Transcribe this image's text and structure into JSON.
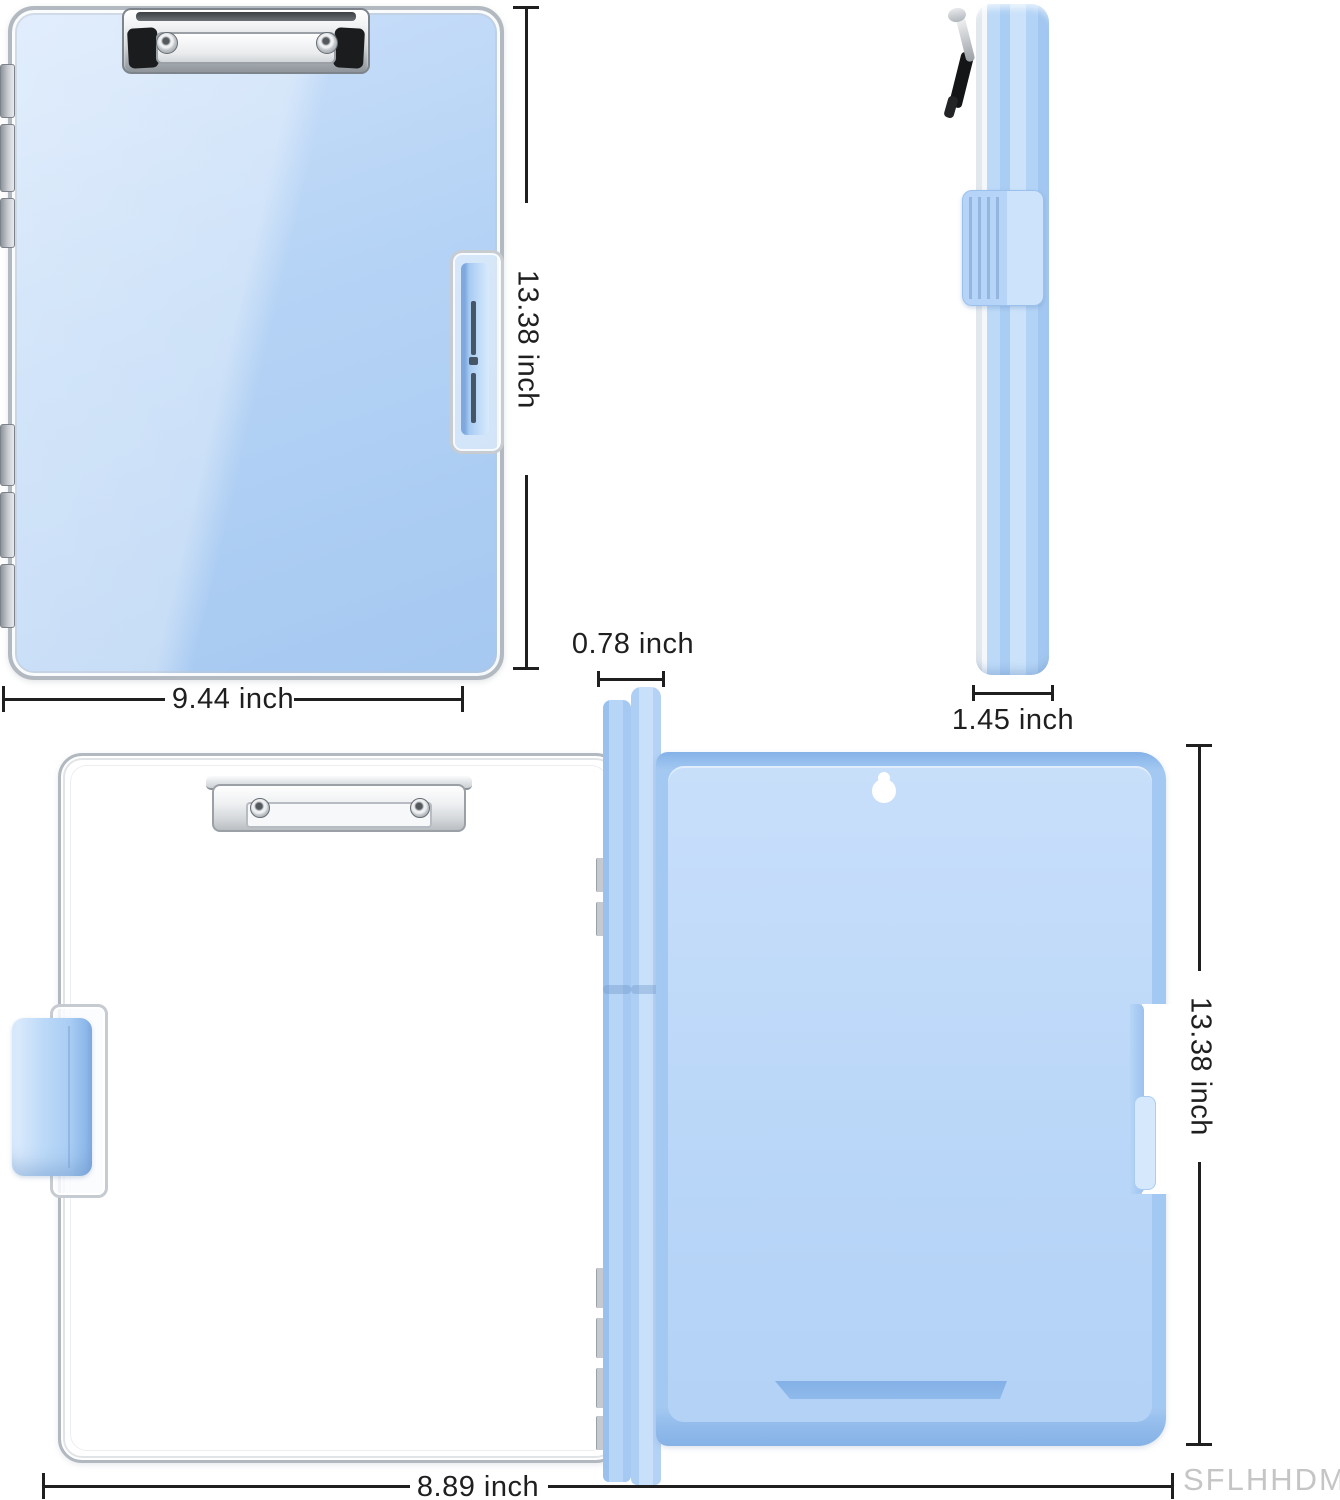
{
  "diagram": {
    "watermark": "SFLHHDM",
    "dimensions": {
      "front_height": "13.38 inch",
      "front_width": "9.44 inch",
      "spine_thickness": "0.78 inch",
      "side_thickness": "1.45 inch",
      "back_height": "13.38 inch",
      "back_width": "8.89 inch"
    },
    "icons": {
      "hang_hole": "keyhole-shape",
      "clip": "metal-spring-clip",
      "latch": "side-latch-tab"
    },
    "colors": {
      "board_blue": "#aecff4",
      "panel_frame_blue": "#9cc2ef",
      "panel_inner_blue": "#c0dbf8",
      "slot_blue": "#86b2e8",
      "dimension_ink": "#1f1f1f",
      "watermark_gray": "#c5c5c5"
    }
  }
}
